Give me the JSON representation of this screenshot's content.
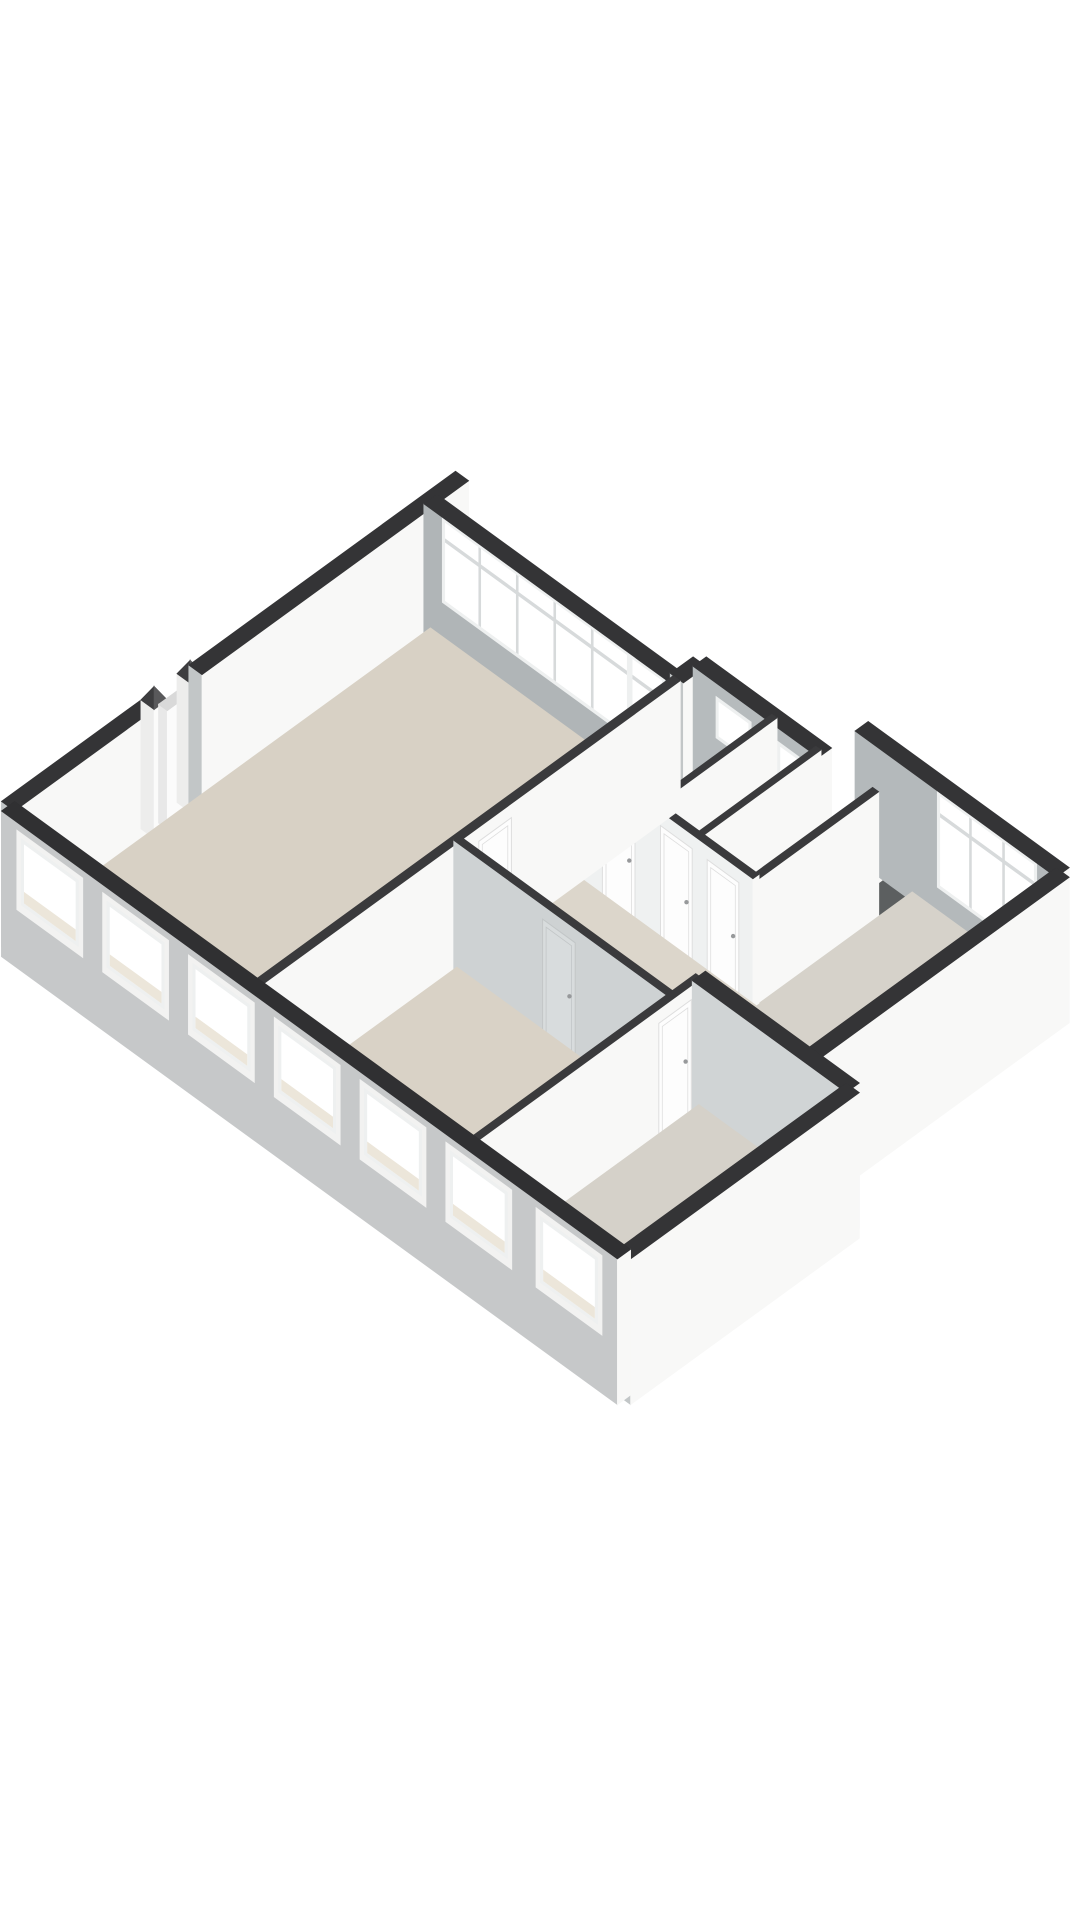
{
  "view": {
    "width": 1080,
    "height": 1920,
    "background": "#ffffff"
  },
  "iso": {
    "ox": 8,
    "oy": 935,
    "kx": 44,
    "ky": 32,
    "kz": 56,
    "wallHeight": 2.3
  },
  "palette": {
    "bg": "#ffffff",
    "cap": "#343436",
    "capInterior": "#3a3a3c",
    "faceL": "#c2c6c7",
    "faceR": "#f8f8f7",
    "glass": "#ffffff",
    "winFrame": "#eef0f0",
    "mullion": "#d7dadb",
    "revealWhite": "#f2f2f1",
    "sillBeige": "#ece6da",
    "floor": "#d8d1c5",
    "doorWhite": "#fdfdfd",
    "doorWhiteStroke": "#dedede",
    "doorGray": "#d8dcdd",
    "doorGrayStroke": "#c2c6c7",
    "handle": "#97999b",
    "shaftDark": "#2e3031",
    "shaftGray": "#5c5f60",
    "trayBase": "#cfd2d3",
    "traySpeckle": "#aeb2b4",
    "basinTop": "#fafbfb"
  },
  "elements": [
    {
      "t": "wall",
      "name": "nw-facade-lower",
      "a": [
        0,
        0
      ],
      "b": [
        0,
        3.2
      ],
      "th": 0.3,
      "base": -0.3
    },
    {
      "t": "post",
      "name": "entry-post-1",
      "at": [
        0,
        3.32
      ],
      "size": 0.3,
      "h": 2.3
    },
    {
      "t": "box",
      "name": "entry-door",
      "u": [
        -0.04,
        0.16
      ],
      "v": [
        3.46,
        4.0
      ],
      "h": 2.12,
      "top": "#d9d9d9",
      "faceL": "#e8e8e8",
      "faceR": "#fbfbfb"
    },
    {
      "t": "post",
      "name": "entry-post-2",
      "at": [
        0,
        4.14
      ],
      "size": 0.3,
      "h": 2.3
    },
    {
      "t": "wall",
      "name": "nw-facade-upper-with-stub",
      "a": [
        0,
        4.26
      ],
      "b": [
        0,
        10.32
      ],
      "th": 0.3,
      "base": -0.3
    },
    {
      "t": "wall",
      "name": "living-window-band-wall",
      "a": [
        0,
        9.6
      ],
      "b": [
        5.6,
        9.6
      ],
      "th": 0.3,
      "faceL": "#b0b5b7",
      "features": [
        {
          "kind": "window",
          "from": 0.42,
          "to": 4.68,
          "sill": 0.78,
          "head": 2.3,
          "lites": 5,
          "transom": 1.92
        },
        {
          "kind": "window",
          "from": 4.68,
          "to": 5.48,
          "sill": 0.1,
          "head": 2.3,
          "lites": 1,
          "transom": 1.92
        }
      ]
    },
    {
      "t": "wall",
      "name": "massing-step-wall-north",
      "a": [
        5.6,
        9.6
      ],
      "b": [
        5.6,
        10.12
      ],
      "th": 0.3,
      "base": -0.3
    },
    {
      "t": "wall",
      "name": "bathroom-ne-wall",
      "a": [
        5.6,
        10.12
      ],
      "b": [
        8.45,
        10.12
      ],
      "th": 0.3,
      "faceL": "#b6bbbd",
      "features": [
        {
          "kind": "window",
          "from": 6.12,
          "to": 6.92,
          "sill": 1.32,
          "head": 2.06,
          "lites": 1
        },
        {
          "kind": "window",
          "from": 7.52,
          "to": 8.18,
          "sill": 1.32,
          "head": 2.06,
          "lites": 1
        }
      ]
    },
    {
      "t": "wall",
      "name": "shaft-lip-wall",
      "a": [
        8.45,
        10.12
      ],
      "b": [
        9.6,
        10.12
      ],
      "th": 0.18,
      "h": 0.48,
      "cap": "#4a4a4c"
    },
    {
      "t": "floor",
      "name": "shaft-floor-dark",
      "u": [
        8.45,
        9.02
      ],
      "v": [
        10.12,
        10.95
      ],
      "fill": "#2e3031"
    },
    {
      "t": "floor",
      "name": "shaft-floor-gray",
      "u": [
        9.02,
        9.6
      ],
      "v": [
        10.12,
        10.95
      ],
      "fill": "#5c5f60"
    },
    {
      "t": "wall",
      "name": "shaft-divider",
      "a": [
        9.02,
        10.12
      ],
      "b": [
        9.02,
        10.95
      ],
      "th": 0.12,
      "h": 0.48,
      "cap": "#4a4a4c"
    },
    {
      "t": "wall",
      "name": "ne-wall-right-bedroom",
      "a": [
        8.45,
        10.95
      ],
      "b": [
        13.02,
        10.95
      ],
      "th": 0.3,
      "faceL": "#b4b9bb",
      "features": [
        {
          "kind": "window",
          "from": 10.32,
          "to": 12.58,
          "sill": 0.58,
          "head": 2.3,
          "lites": 3,
          "transom": 1.9
        }
      ]
    },
    {
      "t": "floor",
      "name": "bathroom-floor",
      "u": [
        5.6,
        7.3
      ],
      "v": [
        7.4,
        10.12
      ],
      "fill": "#d7d0c5"
    },
    {
      "t": "floor",
      "name": "shower-room-floor",
      "u": [
        7.3,
        8.3
      ],
      "v": [
        7.4,
        10.12
      ],
      "fill": "#d7d0c5"
    },
    {
      "t": "floor",
      "name": "closet-floor",
      "u": [
        8.3,
        9.6
      ],
      "v": [
        7.4,
        10.12
      ],
      "fill": "#dad4c9"
    },
    {
      "t": "box",
      "name": "washbasin",
      "u": [
        5.8,
        7.04
      ],
      "v": [
        9.58,
        10.0
      ],
      "h": 0.55,
      "top": "#fafbfb",
      "faceL": "#e9ebeb",
      "faceR": "#ffffff"
    },
    {
      "t": "box",
      "name": "shower-tray",
      "u": [
        7.42,
        8.22
      ],
      "v": [
        9.32,
        10.02
      ],
      "h": 0.12,
      "top": "#f4f5f5",
      "faceL": "#e8eaea",
      "faceR": "#f6f7f7",
      "patternTop": true,
      "topInset": 0.07
    },
    {
      "t": "wall",
      "name": "bathroom-shower-divider",
      "a": [
        7.3,
        7.4
      ],
      "b": [
        7.3,
        10.12
      ],
      "th": 0.12,
      "cap": "#3a3a3c"
    },
    {
      "t": "wall",
      "name": "shower-closet-divider",
      "a": [
        8.3,
        7.4
      ],
      "b": [
        8.3,
        10.12
      ],
      "th": 0.12,
      "cap": "#3a3a3c"
    },
    {
      "t": "wall",
      "name": "right-bedroom-nw-wall",
      "a": [
        9.6,
        5.96
      ],
      "b": [
        9.6,
        10.12
      ],
      "th": 0.14,
      "cap": "#3a3a3c",
      "features": [
        {
          "kind": "door",
          "from": 6.34,
          "to": 7.08
        }
      ]
    },
    {
      "t": "floor",
      "name": "right-bedroom-floor",
      "u": [
        9.6,
        13.02
      ],
      "v": [
        5.96,
        10.95
      ],
      "fill": "#d6d2ca"
    },
    {
      "t": "wall",
      "name": "se-facade-right",
      "a": [
        13.02,
        5.2
      ],
      "b": [
        13.02,
        10.95
      ],
      "th": 0.3,
      "base": -0.3
    },
    {
      "t": "wall",
      "name": "bath-block-sw-wall",
      "a": [
        5.6,
        7.4
      ],
      "b": [
        9.6,
        7.4
      ],
      "th": 0.14,
      "cap": "#3a3a3c",
      "faceL": "#eff1f1",
      "features": [
        {
          "kind": "door",
          "from": 6.18,
          "to": 6.92
        },
        {
          "kind": "door",
          "from": 7.5,
          "to": 8.22
        },
        {
          "kind": "door",
          "from": 8.56,
          "to": 9.28
        }
      ]
    },
    {
      "t": "floor",
      "name": "hall-floor",
      "poly": [
        [
          5.6,
          4.6
        ],
        [
          10.5,
          4.6
        ],
        [
          10.5,
          5.96
        ],
        [
          9.6,
          5.96
        ],
        [
          9.6,
          7.4
        ],
        [
          5.6,
          7.4
        ]
      ],
      "fill": "#dcd6cb"
    },
    {
      "t": "floor",
      "name": "living-room-floor",
      "u": [
        0,
        5.6
      ],
      "v": [
        0,
        9.6
      ],
      "fill": "#d8d1c5"
    },
    {
      "t": "wall",
      "name": "living-se-wall",
      "a": [
        5.6,
        0
      ],
      "b": [
        5.6,
        9.6
      ],
      "th": 0.16,
      "cap": "#3a3a3c",
      "features": [
        {
          "kind": "door",
          "from": 5.02,
          "to": 5.76
        }
      ]
    },
    {
      "t": "wall",
      "name": "corridor-sw-wall",
      "a": [
        5.6,
        4.6
      ],
      "b": [
        10.5,
        4.6
      ],
      "th": 0.14,
      "cap": "#3a3a3c",
      "faceL": "#ced2d3",
      "features": [
        {
          "kind": "door",
          "from": 7.62,
          "to": 8.36,
          "gray": true
        }
      ]
    },
    {
      "t": "floor",
      "name": "bedroom-2-floor",
      "u": [
        5.6,
        10.5
      ],
      "v": [
        0,
        4.6
      ],
      "fill": "#d9d2c6"
    },
    {
      "t": "wall",
      "name": "bedroom-3-nw-wall",
      "a": [
        10.5,
        0
      ],
      "b": [
        10.5,
        5.2
      ],
      "th": 0.14,
      "cap": "#3a3a3c",
      "features": [
        {
          "kind": "door",
          "from": 4.22,
          "to": 4.96
        }
      ]
    },
    {
      "t": "wall",
      "name": "bedroom-3-ne-wall",
      "a": [
        10.5,
        5.2
      ],
      "b": [
        14.0,
        5.2
      ],
      "th": 0.3,
      "base": -0.3,
      "faceL": "#d0d4d5"
    },
    {
      "t": "floor",
      "name": "bedroom-3-floor",
      "u": [
        10.5,
        14.0
      ],
      "v": [
        0,
        5.2
      ],
      "fill": "#d5d1c9"
    },
    {
      "t": "wall",
      "name": "se-facade-bottom",
      "a": [
        14.0,
        0
      ],
      "b": [
        14.0,
        5.2
      ],
      "th": 0.3,
      "base": -0.3
    },
    {
      "t": "wall",
      "name": "sw-facade",
      "a": [
        0,
        0
      ],
      "b": [
        14.0,
        0
      ],
      "th": 0.3,
      "base": -0.3,
      "faceL": "#c6c8c9",
      "cap": "#303032",
      "features": [
        {
          "kind": "window",
          "from": 0.45,
          "to": 1.75,
          "sill": 0.88,
          "head": 2.06,
          "lites": 1,
          "ext": true
        },
        {
          "kind": "window",
          "from": 2.4,
          "to": 3.7,
          "sill": 0.88,
          "head": 2.06,
          "lites": 1,
          "ext": true
        },
        {
          "kind": "window",
          "from": 4.35,
          "to": 5.65,
          "sill": 0.88,
          "head": 2.06,
          "lites": 1,
          "ext": true
        },
        {
          "kind": "window",
          "from": 6.3,
          "to": 7.6,
          "sill": 0.88,
          "head": 2.06,
          "lites": 1,
          "ext": true
        },
        {
          "kind": "window",
          "from": 8.25,
          "to": 9.55,
          "sill": 0.88,
          "head": 2.06,
          "lites": 1,
          "ext": true
        },
        {
          "kind": "window",
          "from": 10.2,
          "to": 11.5,
          "sill": 0.88,
          "head": 2.06,
          "lites": 1,
          "ext": true
        },
        {
          "kind": "window",
          "from": 12.25,
          "to": 13.55,
          "sill": 0.88,
          "head": 2.06,
          "lites": 1,
          "ext": true
        }
      ]
    }
  ]
}
